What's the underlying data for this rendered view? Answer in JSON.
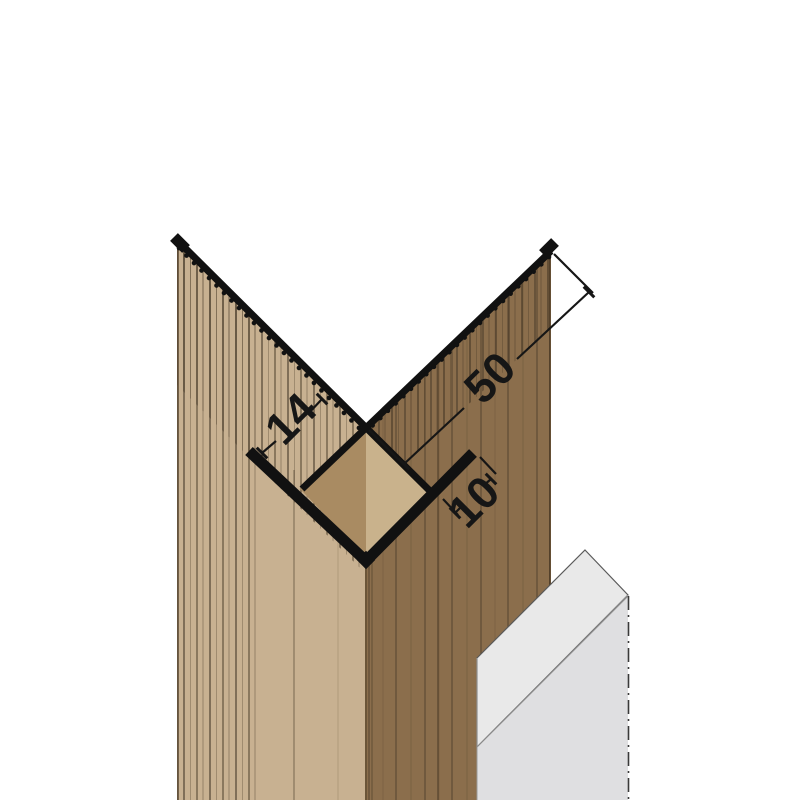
{
  "drawing": {
    "title": "corner-profile-technical-drawing",
    "dimensions": {
      "panel_thickness_label": "14",
      "flange_width_label": "50",
      "return_leg_label": "10"
    },
    "colors": {
      "background": "#ffffff",
      "left_panel": "#c8b191",
      "right_panel": "#8b6e4c",
      "grain_line": "#3f3222",
      "diamond_left": "#a98b62",
      "diamond_right": "#c9b28c",
      "profile_black": "#111111",
      "substrate_top": "#e9e9e9",
      "substrate_front": "#dfdfe1",
      "dimension_line": "#161616"
    }
  }
}
